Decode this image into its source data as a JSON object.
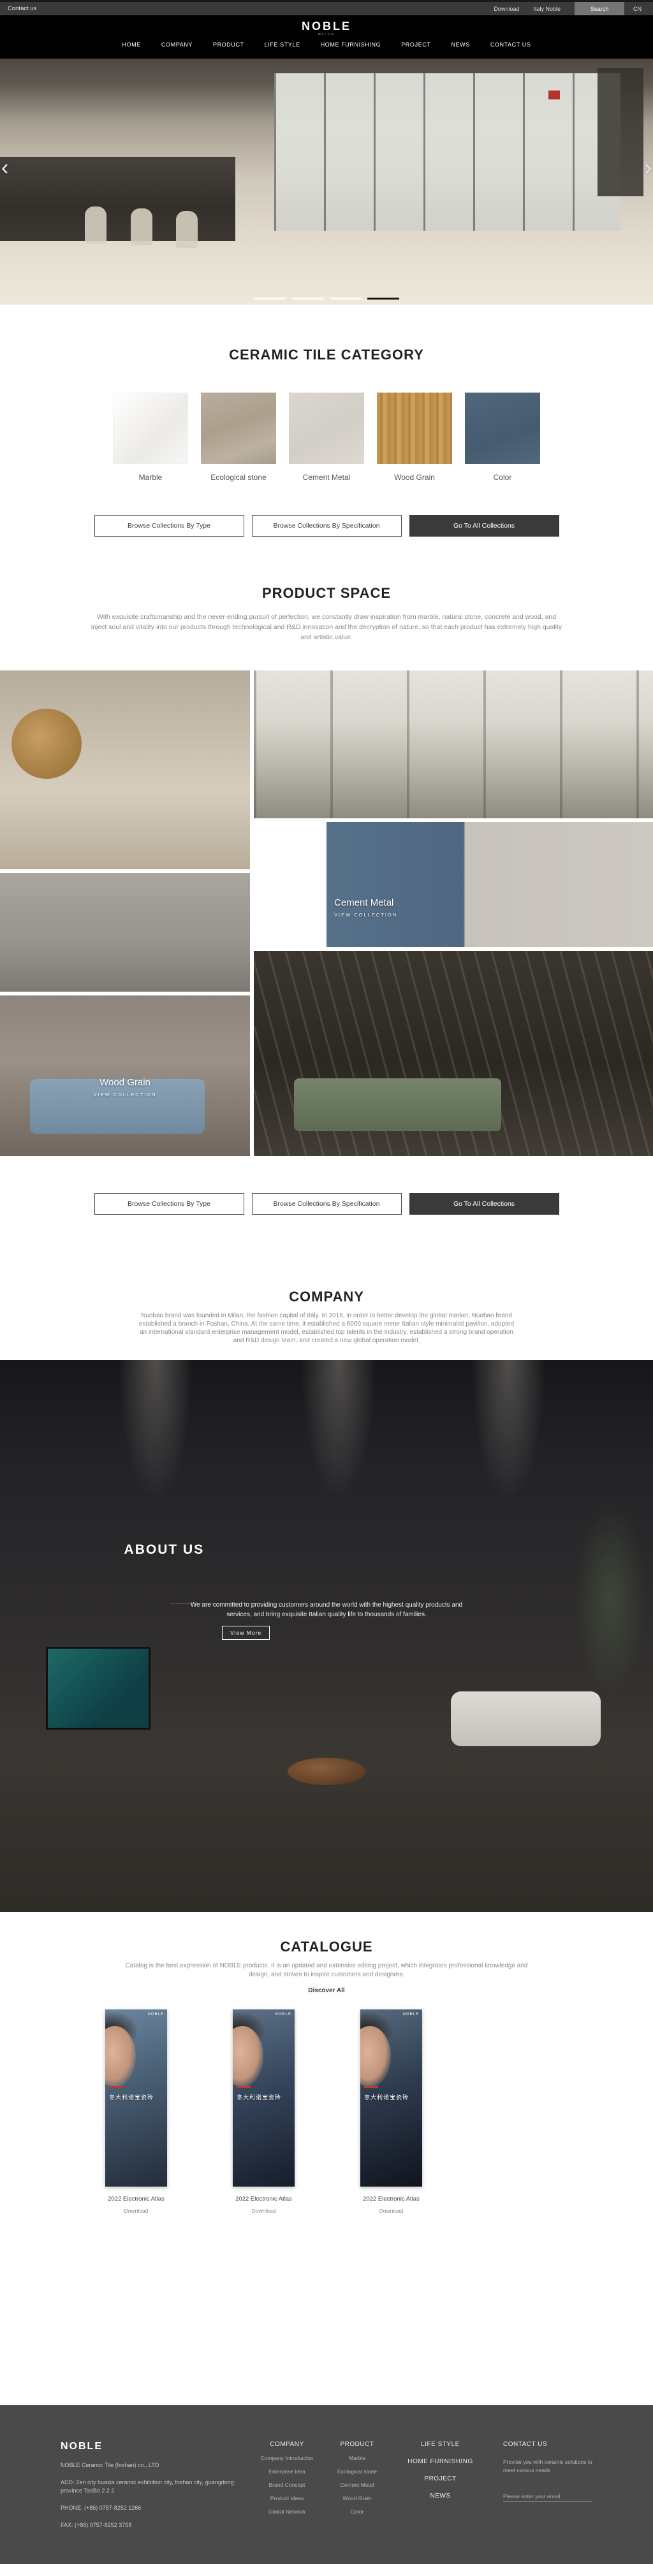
{
  "topbar": {
    "contact_label": "Contact us",
    "download_label": "Download",
    "italy_label": "Italy Noble",
    "search_label": "Search",
    "lang_label": "CN"
  },
  "brand": {
    "logo": "NOBLE",
    "tagline": "MILAN"
  },
  "nav": {
    "items": [
      {
        "label": "HOME"
      },
      {
        "label": "COMPANY"
      },
      {
        "label": "PRODUCT"
      },
      {
        "label": "LIFE STYLE"
      },
      {
        "label": "HOME FURNISHING"
      },
      {
        "label": "PROJECT"
      },
      {
        "label": "NEWS"
      },
      {
        "label": "CONTACT US"
      }
    ]
  },
  "hero": {
    "prev": "‹",
    "next": "›",
    "slide_count": 4,
    "active_slide": 4
  },
  "category": {
    "title": "CERAMIC TILE CATEGORY",
    "items": [
      {
        "label": "Marble"
      },
      {
        "label": "Ecological stone"
      },
      {
        "label": "Cement Metal"
      },
      {
        "label": "Wood Grain"
      },
      {
        "label": "Color"
      }
    ]
  },
  "collection_buttons": {
    "by_type": "Browse Collections By Type",
    "by_spec": "Browse Collections By Specification",
    "go_all": "Go To All Collections"
  },
  "product_space": {
    "title": "PRODUCT SPACE",
    "description": "With exquisite craftsmanship and the never-ending pursuit of perfection, we constantly draw inspiration from marble, natural stone, concrete and wood, and inject soul and vitality into our products through technological and R&D innovation and the decryption of nature, so that each product has extremely high quality and artistic value.",
    "tiles": [
      {
        "label": "Marbl",
        "link": "VIEW COLLECTION"
      },
      {
        "label": "Cement Metal",
        "link": "VIEW COLLECTION"
      },
      {
        "label": "Wood Grain",
        "link": "VIEW COLLECTION"
      }
    ]
  },
  "company": {
    "title": "COMPANY",
    "description": "Nuobao brand was founded in Milan, the fashion capital of Italy. In 2016, in order to better develop the global market, Nuobao brand established a branch in Foshan, China. At the same time, it established a 6000 square meter Italian style minimalist pavilion, adopted an international standard enterprise management model, established top talents in the industry, established a strong brand operation and R&D design team, and created a new global operation model."
  },
  "about": {
    "title": "ABOUT US",
    "description": "We are committed to providing customers around the world with the highest quality products and services, and bring exquisite Italian quality life to thousands of families.",
    "button_label": "View More"
  },
  "catalogue": {
    "title": "CATALOGUE",
    "description": "Catalog is the best expression of NOBLE products. It is an updated and extensive editing project, which integrates professional knowledge and design, and strives to inspire customers and designers.",
    "discover_label": "Discover All",
    "items": [
      {
        "brand": "NOBLE",
        "cover_title": "意大利诺宝瓷砖",
        "name": "2022 Electronic Atlas",
        "download_label": "Download"
      },
      {
        "brand": "NOBLE",
        "cover_title": "意大利诺宝瓷砖",
        "name": "2022 Electronic Atlas",
        "download_label": "Download"
      },
      {
        "brand": "NOBLE",
        "cover_title": "意大利诺宝瓷砖",
        "name": "2022 Electronic Atlas",
        "download_label": "Download"
      }
    ]
  },
  "footer": {
    "logo": "NOBLE",
    "company_name": "NOBLE Ceramic Tile (foshan) co., LTD",
    "address": "ADD:  Zen city huaxia ceramic exhibition city, foshan city, guangdong province TaoBo 2 2 2",
    "phone": "PHONE:  (+86) 0757-8252 1266",
    "fax": "FAX:  (+86) 0757-8252 3758",
    "columns": [
      {
        "title": "COMPANY",
        "items": [
          "Company Introduction",
          "Enterprise Idea",
          "Brand Concept",
          "Product Ideas",
          "Global Network"
        ]
      },
      {
        "title": "PRODUCT",
        "items": [
          "Marble",
          "Ecological stone",
          "Cement Metal",
          "Wood Grain",
          "Color"
        ]
      },
      {
        "title": "LIFE STYLE"
      },
      {
        "title": "HOME FURNISHING"
      },
      {
        "title": "PROJECT"
      },
      {
        "title": "NEWS"
      }
    ],
    "contact": {
      "title": "CONTACT US",
      "text": "Provide you with ceramic solutions to meet various needs",
      "email_placeholder": "Please enter your email"
    }
  },
  "colors": {
    "accent_red": "#b3342c",
    "footer_bg": "#4a4a4a",
    "dark_button": "#3a3a3a",
    "search_bg": "#757575"
  }
}
